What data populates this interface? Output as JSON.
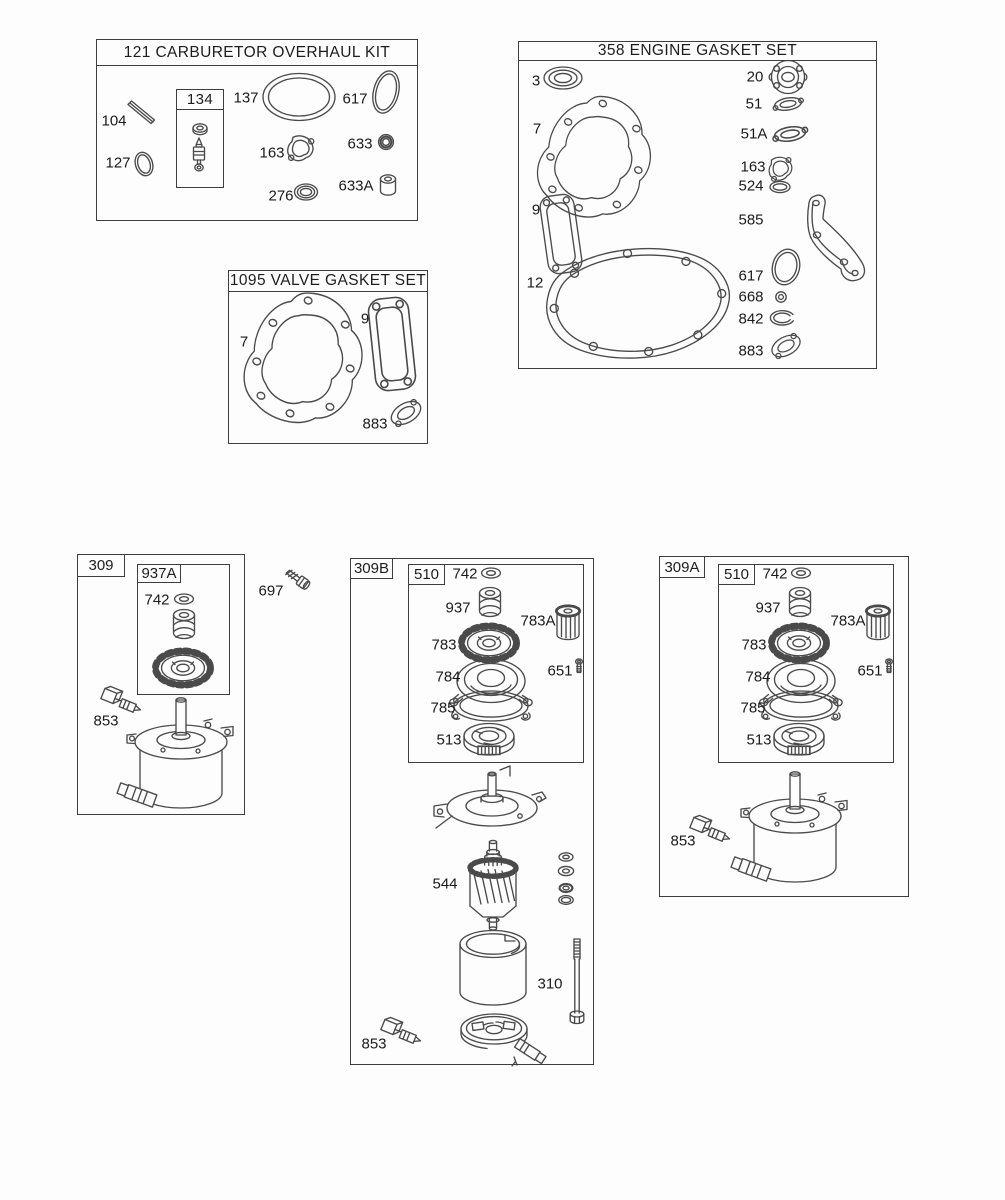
{
  "style": {
    "background": "#fdfdfd",
    "line_color": "#4a4a4a",
    "text_color": "#1b1b1b"
  },
  "carb_kit": {
    "title": "121 CARBURETOR OVERHAUL KIT",
    "inner_box_label": "134",
    "parts": {
      "104": "104",
      "127": "127",
      "137": "137",
      "617": "617",
      "163": "163",
      "633": "633",
      "276": "276",
      "633A": "633A"
    }
  },
  "engine_gasket_set": {
    "title": "358 ENGINE GASKET SET",
    "parts": {
      "3": "3",
      "7": "7",
      "9": "9",
      "12": "12",
      "20": "20",
      "51": "51",
      "51A": "51A",
      "163": "163",
      "524": "524",
      "585": "585",
      "617": "617",
      "668": "668",
      "842": "842",
      "883": "883"
    }
  },
  "valve_gasket_set": {
    "title": "1095 VALVE GASKET SET",
    "parts": {
      "7": "7",
      "9": "9",
      "883": "883"
    }
  },
  "starter_309": {
    "box_label": "309",
    "sub_box_label": "937A",
    "parts": {
      "742": "742",
      "853": "853"
    }
  },
  "loose_parts": {
    "697": "697"
  },
  "starter_309b": {
    "box_label": "309B",
    "sub_box_label": "510",
    "parts": {
      "742": "742",
      "937": "937",
      "783A": "783A",
      "783": "783",
      "651": "651",
      "784": "784",
      "785": "785",
      "513": "513",
      "544": "544",
      "310": "310",
      "853": "853"
    }
  },
  "starter_309a": {
    "box_label": "309A",
    "sub_box_label": "510",
    "parts": {
      "742": "742",
      "937": "937",
      "783A": "783A",
      "783": "783",
      "651": "651",
      "784": "784",
      "785": "785",
      "513": "513",
      "853": "853"
    }
  }
}
